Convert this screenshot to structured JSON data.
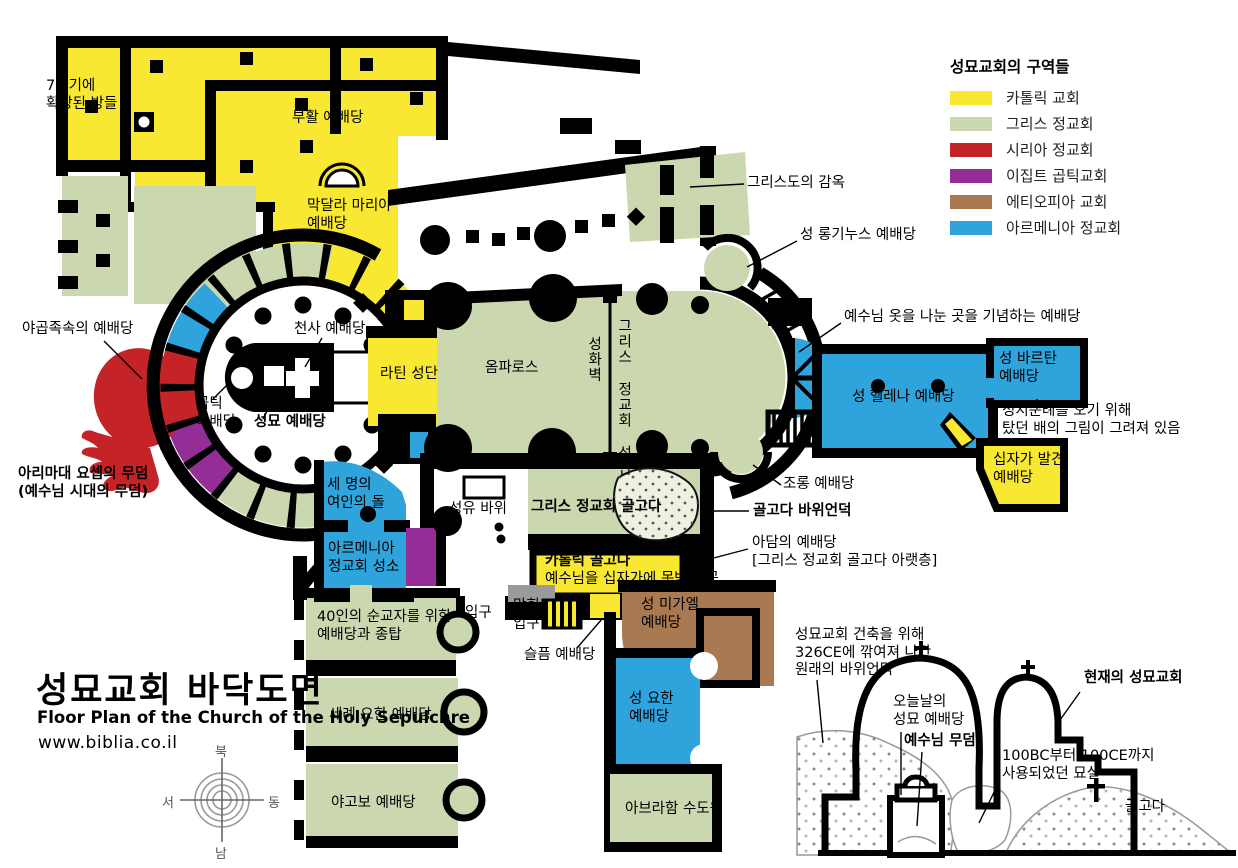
{
  "colors": {
    "catholic": "#F9E831",
    "greek": "#CBD8AF",
    "syrian": "#C42328",
    "coptic": "#942D96",
    "ethiopian": "#A97951",
    "armenian": "#2FA3DC",
    "wall": "#000000",
    "gray_block": "#9A9A9A",
    "rock_dot": "#555555",
    "section_line": "#999999"
  },
  "legend": {
    "title": "성묘교회의 구역들",
    "items": [
      {
        "key": "catholic",
        "label": "카톨릭 교회",
        "color": "#F9E831"
      },
      {
        "key": "greek",
        "label": "그리스 정교회",
        "color": "#CBD8AF"
      },
      {
        "key": "syrian",
        "label": "시리아 정교회",
        "color": "#C42328"
      },
      {
        "key": "coptic",
        "label": "이집트 곱틱교회",
        "color": "#942D96"
      },
      {
        "key": "ethiopian",
        "label": "에티오피아 교회",
        "color": "#A97951"
      },
      {
        "key": "armenian",
        "label": "아르메니아 정교회",
        "color": "#2FA3DC"
      }
    ]
  },
  "title_block": {
    "ko": "성묘교회 바닥도면",
    "en": "Floor Plan of the Church of the Holy Sepulchre",
    "url": "www.biblia.co.il"
  },
  "compass": {
    "n": "북",
    "s": "남",
    "e": "동",
    "w": "서"
  },
  "plan_labels": {
    "rooms7c": "7세기에\n확장된 방들",
    "resurrection": "부활 예배당",
    "magdalene": "막달라 마리아\n예배당",
    "prison": "그리스도의 감옥",
    "longinus": "성 롱기누스 예배당",
    "robes": "예수님 옷을 나눈 곳을 기념하는 예배당",
    "jacobites": "야곱족속의 예배당",
    "angel": "천사 예배당",
    "latin": "라틴 성단",
    "coptic_chapel": "곱틱\n예배당",
    "sepulchre": "성묘 예배당",
    "omphalos": "옴파로스",
    "icon_wall": "성화벽",
    "greek_altar": "그리스 정교회 성단",
    "helena": "성 헬레나 예배당",
    "vartan": "성 바르탄\n예배당",
    "ship_note": "성지순례를 오기 위해\n탔던 배의 그림이 그려져 있음",
    "cross_found": "십자가 발견\n예배당",
    "arimathea": "아리마대 요셉의 무덤\n(예수님 시대의 무덤)",
    "three_women": "세 명의\n여인의 돌",
    "armenian_sanctuary": "아르메니아\n정교회 성소",
    "anointing": "성유 바위",
    "greek_golgotha": "그리스 정교회 골고다",
    "catholic_golgotha": "카톨릭 골고다",
    "nailing": "예수님을 십자가에 못박은 곳",
    "golgotha_rock": "골고다 바위언덕",
    "mocking": "조롱 예배당",
    "adam": "아담의 예배당\n[그리스 정교회 골고다 아랫층]",
    "forty_martyrs": "40인의 순교자를 위한\n예배당과 종탑",
    "baptist": "세례 요한 예배당",
    "james": "야고보 예배당",
    "entrance": "입구",
    "blocked_entrance": "막힌\n입구",
    "sorrow": "슬픔 예배당",
    "michael": "성 미가엘\n예배당",
    "st_john": "성 요한\n예배당",
    "abraham": "아브라함 수도원"
  },
  "section_labels": {
    "cut_rock": "성묘교회 건축을 위해\n326CE에 깎여져 나간\n원래의 바위언덕",
    "today_chapel": "오늘날의\n성묘 예배당",
    "jesus_tomb": "예수님 무덤",
    "current_church": "현재의 성묘교회",
    "burial_chamber": "100BC부터 100CE까지\n사용되었던 묘실",
    "golgotha": "골고다"
  }
}
